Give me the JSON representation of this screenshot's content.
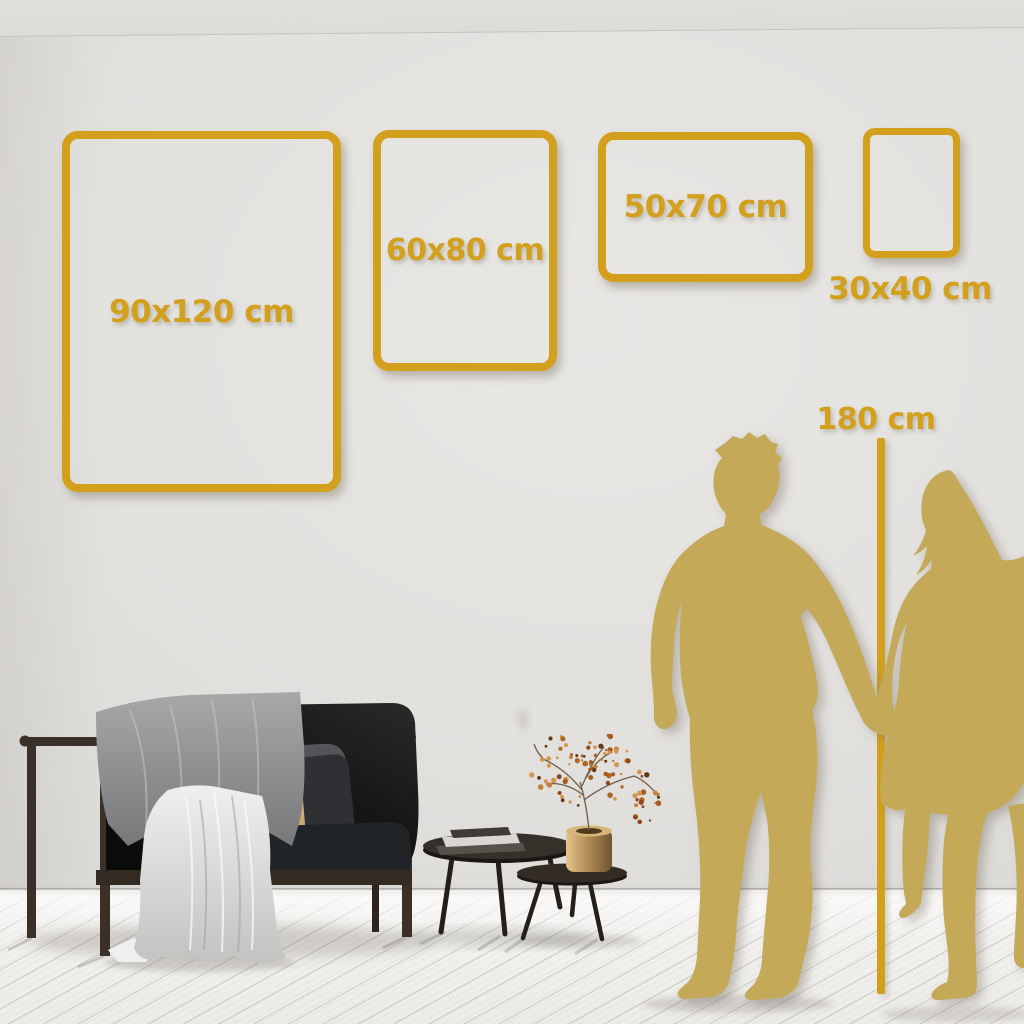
{
  "size_guide": {
    "frames": [
      {
        "label": "90x120 cm"
      },
      {
        "label": "60x80 cm"
      },
      {
        "label": "50x70 cm"
      },
      {
        "label": "30x40 cm"
      }
    ],
    "height_marker": {
      "label": "180 cm"
    }
  },
  "palette": {
    "accent_gold": "#d2a01d",
    "silhouette_gold": "#c3a958",
    "wall": "#e2e0dd",
    "floor": "#f3f2f0",
    "sofa_black": "#121212",
    "sofa_wood": "#3a3027",
    "pillow_beige": "#d9b685",
    "blanket_gray": "#8e9092",
    "drape_white": "#dcdcdb",
    "vase_brass": "#b8935a",
    "berry_rust": "#b06524"
  },
  "decor": {
    "items": [
      "sofa",
      "throw-blanket",
      "white-drape",
      "beige-pillow",
      "coffee-tables",
      "books",
      "brass-vase-with-dried-branches",
      "man-silhouette",
      "woman-silhouette",
      "height-measure-line"
    ]
  }
}
